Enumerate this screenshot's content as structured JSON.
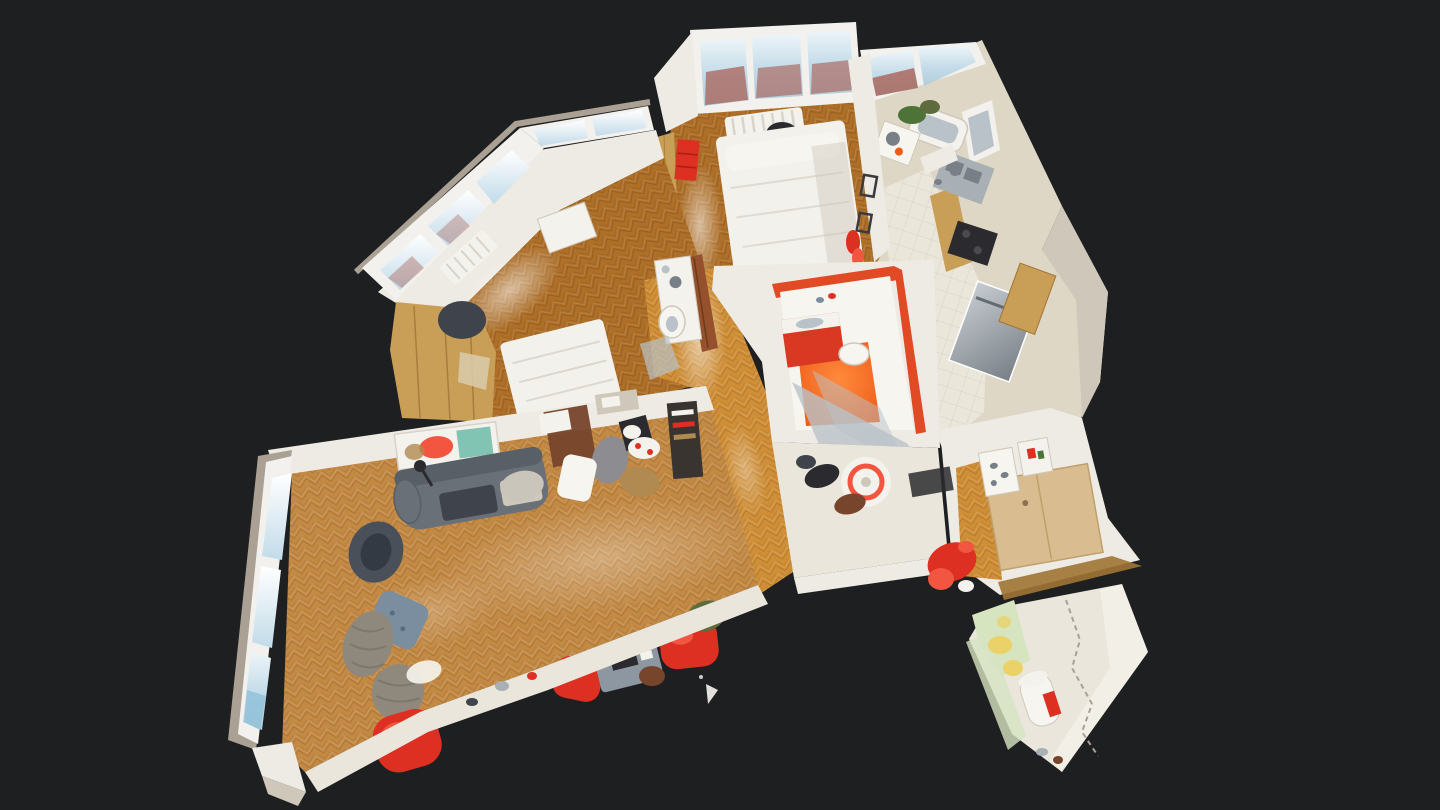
{
  "scene": {
    "label": "3D dollhouse top-down view of a scanned apartment model floating on a dark background",
    "type": "3d-dollhouse-view",
    "viewport": {
      "width": 1440,
      "height": 810
    },
    "colors": {
      "background": "#1e1f21",
      "wall-white": "#eeebe4",
      "wall-bright": "#f7f5f0",
      "wall-cream": "#dfd7c6",
      "wall-shadow": "#cfc8ba",
      "taupe-frame": "#aaa094",
      "window-frame": "#f2f1ed",
      "window-sky": "#c2dbe9",
      "window-sky-bright": "#edf5f9",
      "window-brick": "#a85a4e",
      "glass-gray": "#b9c2c8",
      "parquet-light": "#c38a46",
      "parquet-light-dark": "#9c6624",
      "parquet-mid": "#ae7029",
      "parquet-mid-dark": "#854f17",
      "parquet-bright": "#cf8f38",
      "parquet-bright-dark": "#a4661c",
      "tile": "#eae6da",
      "tile-line": "#d4cec0",
      "oak": "#c99f58",
      "oak-dark": "#9f7434",
      "oak-pale": "#d9bd90",
      "stainless": "#a8afb5",
      "stainless-dark": "#787f86",
      "appliance-dark": "#2b2b2f",
      "sofa-gray": "#6a7078",
      "sofa-dark": "#3f444c",
      "chair-blue": "#7b8ea0",
      "wicker": "#8f897d",
      "red-accent": "#dd2f22",
      "red-bright": "#f25540",
      "orange-floor": "#eb5a17",
      "orange-wall": "#e04a24",
      "vanity-red": "#d93822",
      "door-brown": "#94512b",
      "green-wall": "#d6e4c0",
      "yellow-item": "#ead269",
      "plant-green": "#4d7338",
      "camo-green": "#5d6b3d",
      "clutter-brown": "#76452c",
      "basket-tan": "#b08a50",
      "teal-art": "#74bfae",
      "bed-white": "#f3f1eb",
      "floor-cream": "#eae6db",
      "white-soft": "#f4f2ec"
    },
    "rooms": [
      {
        "id": "living-room",
        "visible_contents": "herringbone parquet, gray sofa, wall painting, wicker chairs, red bean-bag chairs, desk with monitor, bay windows"
      },
      {
        "id": "bedroom-left",
        "visible_contents": "angled bay windows, oak wardrobe, white bed, white desk, radiator"
      },
      {
        "id": "bedroom-top",
        "visible_contents": "white double bed, city-view windows, radiator, red drawers, oak closet"
      },
      {
        "id": "kitchen",
        "visible_contents": "white tile floor, oak cabinets, stainless sink and dishwasher, dark cooktop, city-view window"
      },
      {
        "id": "bathroom-red",
        "visible_contents": "orange floor, red vanity, toilet, glass shower pane, round rug with red ring"
      },
      {
        "id": "bathroom-top",
        "visible_contents": "bathtub, green plants, washbasin unit"
      },
      {
        "id": "wc-nook",
        "visible_contents": "toilet bowl, white console, brown door leaf"
      },
      {
        "id": "hallway",
        "visible_contents": "bright glossy parquet, pale oak wardrobe, doormat, red garment on floor"
      },
      {
        "id": "utility-room",
        "visible_contents": "pale green walls, yellow items, white water heater, cream tile floor"
      }
    ]
  }
}
